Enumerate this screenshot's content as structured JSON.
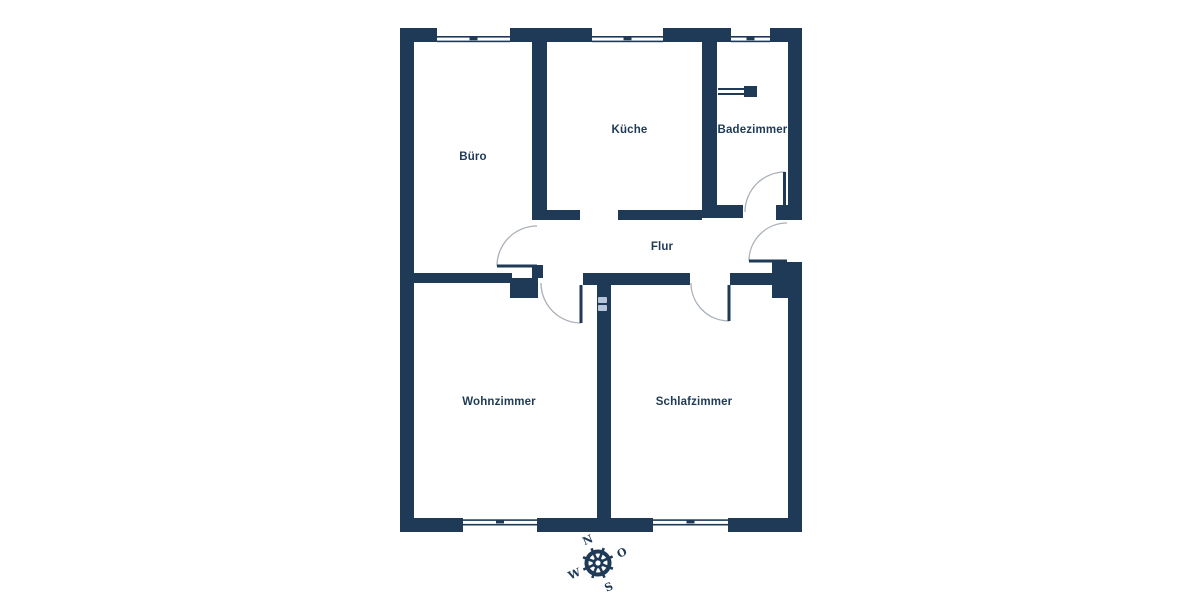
{
  "floorplan": {
    "rooms": [
      {
        "id": "buero",
        "label": "Büro"
      },
      {
        "id": "kueche",
        "label": "Küche"
      },
      {
        "id": "badezimmer",
        "label": "Badezimmer"
      },
      {
        "id": "flur",
        "label": "Flur"
      },
      {
        "id": "wohnzimmer",
        "label": "Wohnzimmer"
      },
      {
        "id": "schlafzimmer",
        "label": "Schlafzimmer"
      }
    ],
    "compass": {
      "north": "N",
      "east": "O",
      "south": "S",
      "west": "W"
    },
    "colors": {
      "wall": "#1e3a57",
      "swing": "#a9b0b8",
      "label": "#1e3a57",
      "watermark": "#b6c5d8",
      "bg": "#ffffff"
    }
  }
}
